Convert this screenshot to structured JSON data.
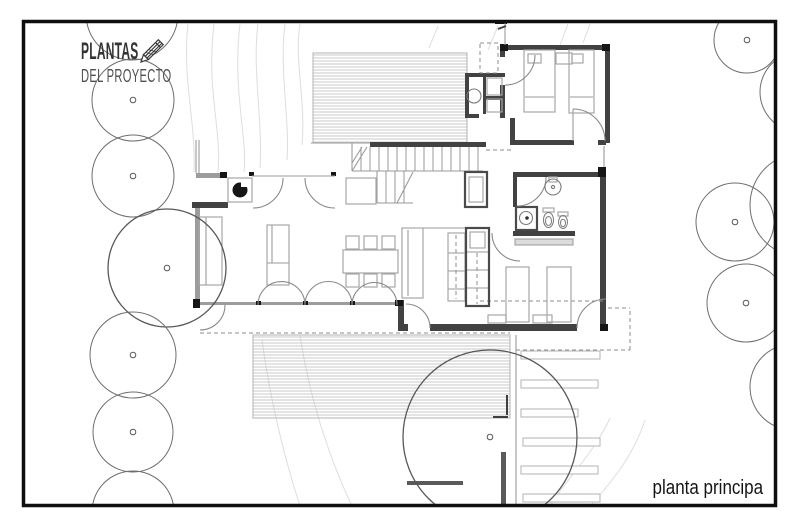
{
  "header": {
    "line1": "PLANTAS",
    "line2": "DEL PROYECTO"
  },
  "caption": {
    "text": "planta principa"
  },
  "colors": {
    "frame": "#0f0f0f",
    "wall_dark": "#424242",
    "wall_gray": "#9c9c9c",
    "post": "#161616",
    "furniture": "#a6a6a6",
    "tree": "#6e6e6e",
    "contour": "#dedede",
    "hatch": "#c2c2c2"
  },
  "plan": {
    "layers": [
      {
        "name": "contour-lines",
        "kind": "paths",
        "stroke": "#dedede",
        "w": 1,
        "items": [
          "M188,24 C182,80 196,120 194,172",
          "M214,24 C206,90 222,130 218,172",
          "M240,24 C232,90 248,140 244,172",
          "M258,24 C252,70 263,120 260,168",
          "M285,24 C279,70 290,120 287,160",
          "M300,24 C294,60 306,100 302,145",
          "M438,26 L429,48",
          "M498,26 L488,50",
          "M568,24 L560,45",
          "M590,24 L583,43",
          "M262,340 C270,400 285,460 300,506",
          "M300,336 C310,400 330,460 352,506",
          "M610,418 C596,450 566,480 550,506",
          "M645,420 C632,460 606,488 590,506"
        ]
      },
      {
        "name": "deck-areas",
        "kind": "decks",
        "stroke": "#b3b3b3",
        "items": [
          [
            313,
            53,
            154,
            90
          ],
          [
            253,
            335,
            257,
            83
          ]
        ]
      },
      {
        "name": "stepping-stones",
        "kind": "rects",
        "stroke": "#b3b3b3",
        "fill": "#ffffff",
        "w": 1,
        "items": [
          [
            521,
            351,
            79,
            8
          ],
          [
            521,
            380,
            77,
            8
          ],
          [
            521,
            409,
            57,
            8
          ],
          [
            523,
            438,
            77,
            8
          ],
          [
            521,
            466,
            77,
            8
          ],
          [
            523,
            494,
            77,
            8
          ]
        ]
      },
      {
        "name": "garden-walls",
        "kind": "rects",
        "fill": "#5a5a5a",
        "items": [
          [
            501,
            452,
            5,
            53
          ],
          [
            407,
            481,
            56,
            4
          ]
        ]
      },
      {
        "name": "stair-treads",
        "kind": "lines",
        "stroke": "#8f8f8f",
        "w": 0.9,
        "items": [
          [
            361,
            147,
            361,
            171
          ],
          [
            370,
            147,
            370,
            171
          ],
          [
            379,
            147,
            379,
            171
          ],
          [
            388,
            147,
            388,
            171
          ],
          [
            397,
            147,
            397,
            171
          ],
          [
            406,
            147,
            406,
            171
          ],
          [
            415,
            147,
            415,
            171
          ],
          [
            424,
            147,
            424,
            171
          ],
          [
            433,
            147,
            433,
            171
          ],
          [
            442,
            147,
            442,
            171
          ],
          [
            451,
            147,
            451,
            171
          ],
          [
            460,
            147,
            460,
            171
          ],
          [
            469,
            147,
            469,
            171
          ],
          [
            478,
            147,
            478,
            171
          ],
          [
            386,
            171,
            386,
            203
          ],
          [
            395,
            171,
            395,
            203
          ],
          [
            404,
            171,
            404,
            203
          ]
        ]
      },
      {
        "name": "walls-gray",
        "kind": "rects",
        "fill": "#9c9c9c",
        "items": [
          [
            195,
            208,
            5,
            95
          ],
          [
            196,
            173,
            26,
            5
          ],
          [
            200,
            302,
            196,
            3
          ]
        ]
      },
      {
        "name": "walls-dark",
        "kind": "rects",
        "fill": "#424242",
        "items": [
          [
            370,
            142,
            116,
            5
          ],
          [
            500,
            45,
            110,
            5
          ],
          [
            605,
            45,
            5,
            98
          ],
          [
            510,
            140,
            64,
            5
          ],
          [
            598,
            140,
            8,
            5
          ],
          [
            500,
            45,
            5,
            12
          ],
          [
            500,
            85,
            5,
            33
          ],
          [
            510,
            118,
            5,
            27
          ],
          [
            465,
            73,
            40,
            4
          ],
          [
            465,
            73,
            4,
            45
          ],
          [
            465,
            114,
            14,
            4
          ],
          [
            483,
            76,
            3,
            38
          ],
          [
            486,
            96,
            17,
            4
          ],
          [
            513,
            172,
            87,
            5
          ],
          [
            600,
            167,
            6,
            163
          ],
          [
            513,
            177,
            4,
            30
          ],
          [
            513,
            231,
            62,
            5
          ],
          [
            192,
            202,
            36,
            6
          ],
          [
            398,
            300,
            6,
            30
          ],
          [
            398,
            324,
            10,
            7
          ],
          [
            430,
            324,
            147,
            7
          ]
        ]
      },
      {
        "name": "posts",
        "kind": "rects",
        "fill": "#161616",
        "items": [
          [
            220,
            172,
            7,
            6
          ],
          [
            193,
            299,
            7,
            9
          ],
          [
            395,
            300,
            8,
            6
          ],
          [
            500,
            44,
            8,
            7
          ],
          [
            602,
            44,
            8,
            7
          ],
          [
            598,
            167,
            8,
            10
          ],
          [
            600,
            324,
            8,
            7
          ],
          [
            249,
            172,
            5,
            4
          ],
          [
            331,
            172,
            5,
            4
          ],
          [
            256,
            301,
            5,
            4
          ],
          [
            303,
            301,
            5,
            4
          ],
          [
            350,
            301,
            5,
            4
          ],
          [
            495,
            20,
            12,
            4
          ]
        ]
      },
      {
        "name": "thin-lines",
        "kind": "lines",
        "stroke": "#9a9a9a",
        "w": 1.1,
        "items": [
          [
            311,
            143,
            370,
            143
          ],
          [
            196,
            140,
            196,
            173
          ],
          [
            199,
            140,
            199,
            173
          ],
          [
            252,
            176,
            335,
            176
          ],
          [
            352,
            143,
            352,
            171
          ],
          [
            352,
            171,
            483,
            171
          ],
          [
            377,
            171,
            377,
            203
          ],
          [
            377,
            203,
            413,
            203
          ],
          [
            505,
            20,
            505,
            45
          ],
          [
            604,
            146,
            604,
            167
          ],
          [
            516,
            335,
            516,
            505
          ],
          [
            402,
            228,
            489,
            228
          ],
          [
            206,
            217,
            206,
            285
          ],
          [
            525,
            97,
            554,
            97
          ],
          [
            570,
            97,
            593,
            97
          ],
          [
            408,
            230,
            408,
            296
          ],
          [
            267,
            263,
            289,
            263
          ],
          [
            272,
            225,
            272,
            263
          ],
          [
            466,
            252,
            489,
            252
          ],
          [
            466,
            270,
            489,
            270
          ],
          [
            466,
            288,
            489,
            288
          ],
          [
            448,
            253,
            465,
            253
          ],
          [
            448,
            271,
            465,
            271
          ],
          [
            448,
            289,
            465,
            289
          ],
          [
            573,
            109,
            573,
            141
          ],
          [
            352,
            171,
            367,
            147
          ],
          [
            352,
            163,
            362,
            147
          ],
          [
            397,
            203,
            413,
            172
          ]
        ]
      },
      {
        "name": "dashed-lines",
        "kind": "lines",
        "stroke": "#8c8c8c",
        "w": 1,
        "dash": "4 3",
        "items": [
          [
            200,
            333,
            510,
            333
          ],
          [
            516,
            350,
            630,
            350
          ],
          [
            630,
            350,
            630,
            308
          ],
          [
            608,
            308,
            630,
            308
          ],
          [
            480,
            301,
            606,
            301
          ],
          [
            456,
            235,
            456,
            299
          ],
          [
            477,
            253,
            477,
            304
          ],
          [
            486,
            150,
            512,
            150
          ]
        ]
      },
      {
        "name": "dashed-rects",
        "kind": "rects",
        "stroke": "#8c8c8c",
        "fill": "none",
        "w": 1,
        "dash": "4 3",
        "items": [
          [
            480,
            43,
            18,
            30
          ]
        ]
      },
      {
        "name": "furniture",
        "kind": "rects",
        "stroke": "#a6a6a6",
        "fill": "none",
        "w": 1.2,
        "items": [
          [
            228,
            178,
            24,
            24
          ],
          [
            346,
            178,
            30,
            26
          ],
          [
            199,
            217,
            23,
            68
          ],
          [
            267,
            225,
            22,
            60
          ],
          [
            343,
            250,
            55,
            23
          ],
          [
            346,
            236,
            13,
            13
          ],
          [
            364,
            236,
            13,
            13
          ],
          [
            382,
            236,
            13,
            13
          ],
          [
            346,
            274,
            13,
            13
          ],
          [
            364,
            274,
            13,
            13
          ],
          [
            382,
            274,
            13,
            13
          ],
          [
            402,
            228,
            21,
            70
          ],
          [
            448,
            233,
            17,
            68
          ],
          [
            470,
            232,
            15,
            16
          ],
          [
            469,
            177,
            14,
            25
          ],
          [
            487,
            78,
            15,
            17
          ],
          [
            487,
            99,
            15,
            13
          ],
          [
            524,
            50,
            31,
            62
          ],
          [
            569,
            50,
            25,
            63
          ],
          [
            556,
            53,
            16,
            11
          ],
          [
            528,
            54,
            13,
            9
          ],
          [
            572,
            54,
            11,
            9
          ],
          [
            506,
            267,
            23,
            55
          ],
          [
            547,
            267,
            24,
            55
          ],
          [
            488,
            315,
            18,
            8
          ],
          [
            533,
            315,
            19,
            8
          ],
          [
            549,
            177,
            8,
            5
          ],
          [
            543,
            208,
            11,
            4
          ],
          [
            558,
            212,
            10,
            4
          ]
        ]
      },
      {
        "name": "casework",
        "kind": "rects",
        "stroke": "#4a4a4a",
        "fill": "none",
        "w": 2.2,
        "items": [
          [
            466,
            228,
            23,
            78
          ],
          [
            465,
            172,
            22,
            35
          ],
          [
            516,
            207,
            21,
            23
          ]
        ]
      },
      {
        "name": "headboard-shelf",
        "kind": "rects",
        "stroke": "#999999",
        "fill": "#dcdcdc",
        "w": 1,
        "items": [
          [
            515,
            239,
            58,
            6
          ]
        ]
      },
      {
        "name": "fixture-circles",
        "kind": "circles",
        "items": [
          {
            "cx": 240,
            "cy": 190,
            "r": 7.5,
            "fill": "#161616",
            "stroke": "none"
          },
          {
            "cx": 474,
            "cy": 96,
            "r": 7,
            "stroke": "#7a7a7a"
          },
          {
            "cx": 553,
            "cy": 187,
            "r": 8,
            "stroke": "#7a7a7a"
          },
          {
            "cx": 553,
            "cy": 187,
            "r": 1.6,
            "stroke": "#7a7a7a"
          },
          {
            "cx": 526,
            "cy": 218,
            "r": 6.5,
            "stroke": "#7a7a7a"
          },
          {
            "cx": 527,
            "cy": 218,
            "r": 1.8,
            "fill": "#333333",
            "stroke": "none"
          }
        ]
      },
      {
        "name": "stove-notch",
        "kind": "rects",
        "fill": "#ffffff",
        "items": [
          [
            241,
            181,
            6,
            6
          ]
        ]
      },
      {
        "name": "sanitary-ellipses",
        "kind": "ellipses",
        "stroke": "#7a7a7a",
        "items": [
          {
            "cx": 548.5,
            "cy": 220,
            "rx": 5,
            "ry": 7.5
          },
          {
            "cx": 548.5,
            "cy": 221,
            "rx": 3,
            "ry": 4.5
          },
          {
            "cx": 563,
            "cy": 222,
            "rx": 4.5,
            "ry": 6.5
          },
          {
            "cx": 563,
            "cy": 223,
            "rx": 2.5,
            "ry": 3.8
          }
        ]
      },
      {
        "name": "door-arcs",
        "kind": "paths",
        "stroke": "#8a8a8a",
        "w": 1.1,
        "items": [
          "M283,178 A30,30 0 0 1 253,208",
          "M305,178 A30,30 0 0 0 335,208",
          "M225,305 A25,25 0 0 1 200,330",
          "M258,305 A23.5,23.5 0 0 1 305,305",
          "M305,305 A23.5,23.5 0 0 1 352,305",
          "M352,305 A22.5,22.5 0 0 1 397,305",
          "M430,328 A24,24 0 0 0 406,304",
          "M492,233 A28,28 0 0 0 520,261",
          "M577,328 A29,29 0 0 1 606,299",
          "M517,206 A29,29 0 0 0 546,177",
          "M505,85 A30,30 0 0 0 535,55",
          "M573,109 A32,32 0 0 1 605,141"
        ]
      },
      {
        "name": "site-marks",
        "kind": "paths",
        "stroke": "#3f3f3f",
        "w": 2,
        "items": [
          "M498,29 L506,26",
          "M507,395 L507,415",
          "M493,417 L508,417"
        ]
      },
      {
        "name": "trees",
        "kind": "trees",
        "stroke": "#6e6e6e",
        "w": 1,
        "items": [
          {
            "cx": 132,
            "cy": 14,
            "r": 46
          },
          {
            "cx": 133,
            "cy": 100,
            "r": 41,
            "dot": true
          },
          {
            "cx": 133,
            "cy": 176,
            "r": 41,
            "dot": true
          },
          {
            "cx": 167,
            "cy": 268,
            "r": 59,
            "dot": true,
            "big": true
          },
          {
            "cx": 133,
            "cy": 355,
            "r": 43,
            "dot": true
          },
          {
            "cx": 133,
            "cy": 432,
            "r": 40,
            "dot": true
          },
          {
            "cx": 133,
            "cy": 512,
            "r": 41
          },
          {
            "cx": 747,
            "cy": 40,
            "r": 33,
            "dot": true
          },
          {
            "cx": 800,
            "cy": 92,
            "r": 40
          },
          {
            "cx": 802,
            "cy": 205,
            "r": 52
          },
          {
            "cx": 735,
            "cy": 222,
            "r": 39,
            "dot": true
          },
          {
            "cx": 746,
            "cy": 303,
            "r": 39,
            "dot": true
          },
          {
            "cx": 793,
            "cy": 387,
            "r": 43
          },
          {
            "cx": 490,
            "cy": 437,
            "r": 87,
            "dot": true,
            "big": true
          }
        ]
      }
    ]
  }
}
